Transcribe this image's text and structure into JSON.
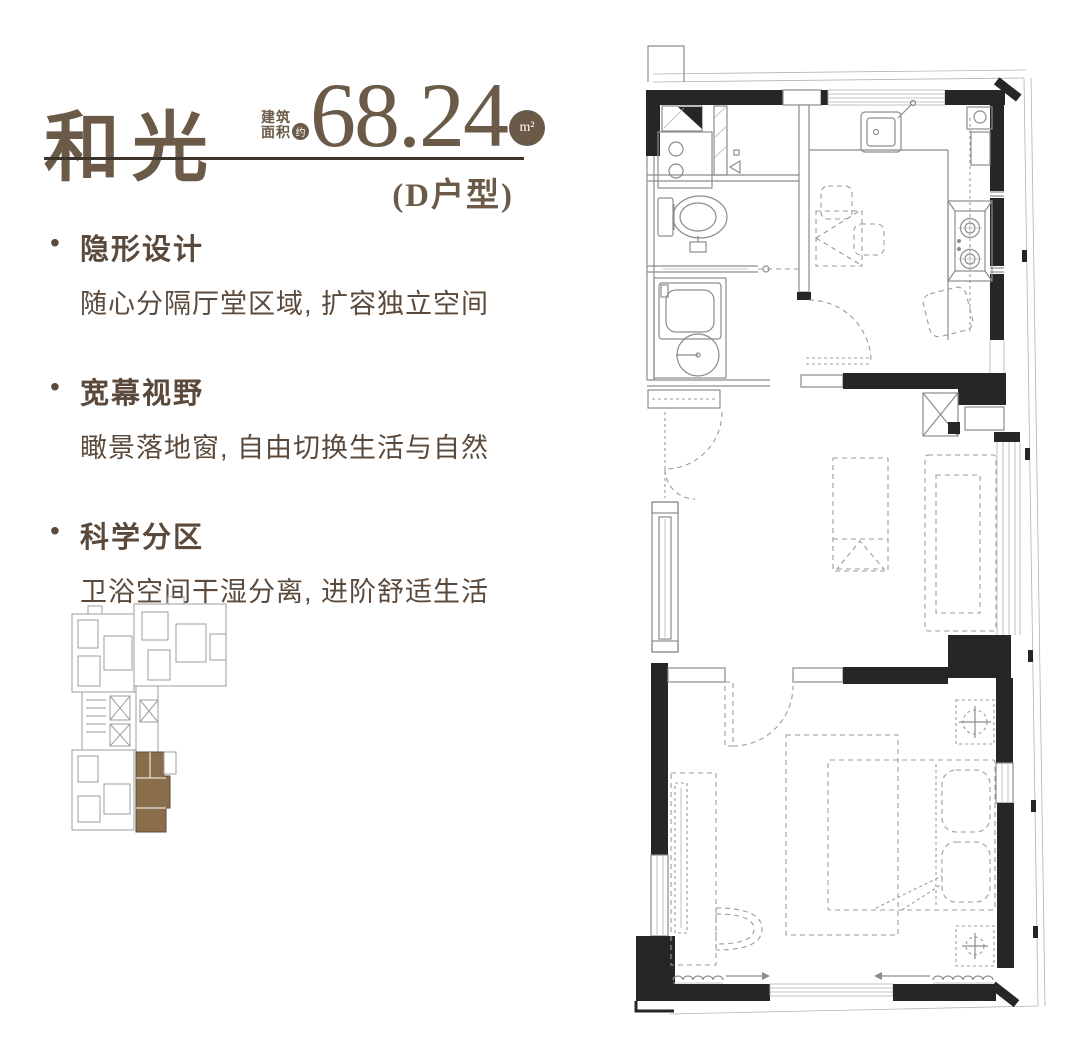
{
  "header": {
    "title": "和光",
    "area_prefix_line1": "建筑",
    "area_prefix_line2": "面积",
    "area_approx": "约",
    "area_value": "68.24",
    "area_unit": "m²",
    "unit_type": "(D户型)"
  },
  "ui": {
    "bullet": "•"
  },
  "features": [
    {
      "title": "隐形设计",
      "desc": "随心分隔厅堂区域, 扩容独立空间"
    },
    {
      "title": "宽幕视野",
      "desc": "瞰景落地窗, 自由切换生活与自然"
    },
    {
      "title": "科学分区",
      "desc": "卫浴空间干湿分离, 进阶舒适生活"
    }
  ],
  "colors": {
    "brand_brown": "#6b5a48",
    "text_brown": "#5b4a3c",
    "rule_dark": "#3c332b",
    "highlighted_unit_brown": "#8a6d4a",
    "wall_black": "#262626",
    "line_gray": "#8c8c8c"
  }
}
